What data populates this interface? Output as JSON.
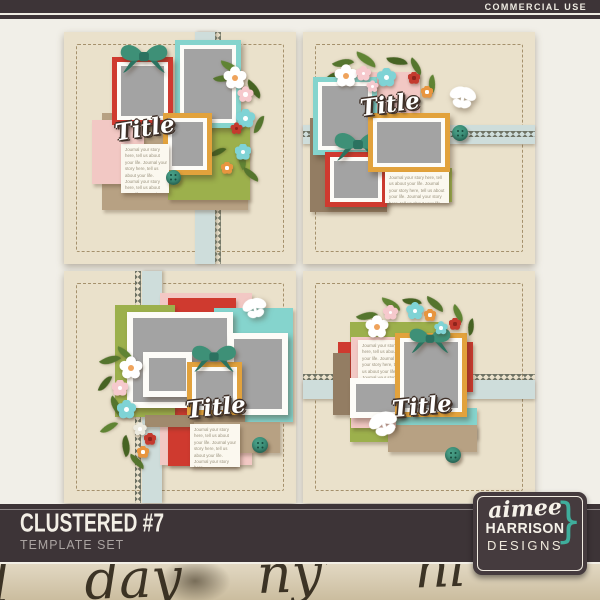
{
  "header": {
    "badge": "COMMERCIAL USE"
  },
  "product": {
    "title": "CLUSTERED #7",
    "subtitle": "TEMPLATE SET"
  },
  "brand": {
    "script": "aimee",
    "name": "HARRISON",
    "suffix": "DESIGNS",
    "brace": "}",
    "accent_color": "#3fae9c"
  },
  "templates": [
    {
      "name": "template-1",
      "title": "Title",
      "journal": "Journal your story here, tell us about your life. Journal your story here, tell us about your life. Journal your story here, tell us about your life. Journal your story here."
    },
    {
      "name": "template-2",
      "title": "Title",
      "journal": "Journal your story here, tell us about your life. Journal your story here, tell us about your life. Journal your story here, tell us about your life."
    },
    {
      "name": "template-3",
      "title": "Title",
      "journal": "Journal your story here, tell us about your life. Journal your story here, tell us about your life. Journal your story here."
    },
    {
      "name": "template-4",
      "title": "Title",
      "journal": "Journal your story here, tell us about your life. Journal your story here, tell us about your life. Journal your story here."
    }
  ],
  "texture": {
    "handwriting": "l day ny’ nl"
  },
  "palette": {
    "bar": "#3d3437",
    "page_bg": "#f1efe8",
    "template_bg": "#eae1cb",
    "ribbon": "#cedddb",
    "rickrack": "#6f7365",
    "stitch": "#a5916c",
    "red": "#cf3a2f",
    "orange": "#e2a23c",
    "aqua": "#85d4cd",
    "green": "#9cb04c",
    "pink": "#f2c8c4",
    "tan": "#b7a183",
    "brown": "#937d63",
    "teal_bow": "#3e9077",
    "photo_gray": "#a3a3a3",
    "flower_white": "#ffffff",
    "flower_pink": "#f6c9cd",
    "flower_aqua": "#7fd3d5",
    "flower_red": "#c43a2e",
    "flower_orange": "#e8953f",
    "leaf_green": "#55752e"
  },
  "icons": [
    "flower-icon",
    "leaf-icon",
    "bow-icon",
    "butterfly-icon",
    "button-embellishment",
    "brace-icon"
  ]
}
